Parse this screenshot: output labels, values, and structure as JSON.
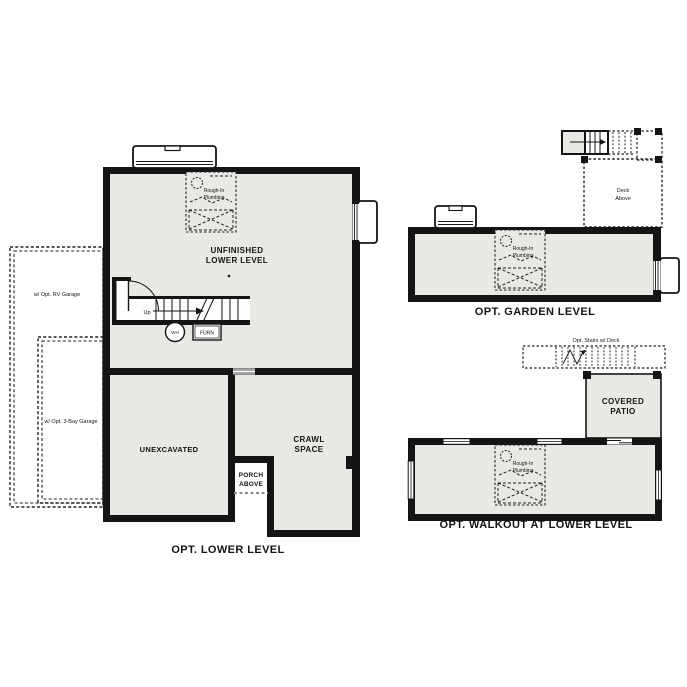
{
  "colors": {
    "wall": "#141414",
    "room_fill": "#e8e8e5",
    "background": "#ffffff",
    "dashed_line": "#222222",
    "porch_dash": "#888888"
  },
  "lower": {
    "caption": "OPT. LOWER LEVEL",
    "unfinished_l1": "UNFINISHED",
    "unfinished_l2": "LOWER LEVEL",
    "unexcavated": "UNEXCAVATED",
    "crawl_l1": "CRAWL",
    "crawl_l2": "SPACE",
    "porch_l1": "PORCH",
    "porch_l2": "ABOVE",
    "up": "Up",
    "wh": "WH",
    "furn": "FURN",
    "rv_garage": "w/ Opt. RV Garage",
    "bay3_garage": "w/ Opt. 3-Bay Garage",
    "roughin_l1": "Rough-In",
    "roughin_l2": "Plumbing"
  },
  "garden": {
    "caption": "OPT. GARDEN LEVEL",
    "deck_l1": "Deck",
    "deck_l2": "Above",
    "roughin_l1": "Rough-In",
    "roughin_l2": "Plumbing"
  },
  "walkout": {
    "caption": "OPT. WALKOUT AT LOWER LEVEL",
    "stairs_label": "Opt. Stairs w/ Deck",
    "patio_l1": "COVERED",
    "patio_l2": "PATIO",
    "roughin_l1": "Rough-In",
    "roughin_l2": "Plumbing"
  },
  "icons": {
    "window_well": "window-well",
    "window": "window-glazing",
    "door": "door-swing",
    "stairs": "stairs",
    "water_heater": "water-heater",
    "furnace": "furnace",
    "rough_in": "rough-in-plumbing"
  }
}
